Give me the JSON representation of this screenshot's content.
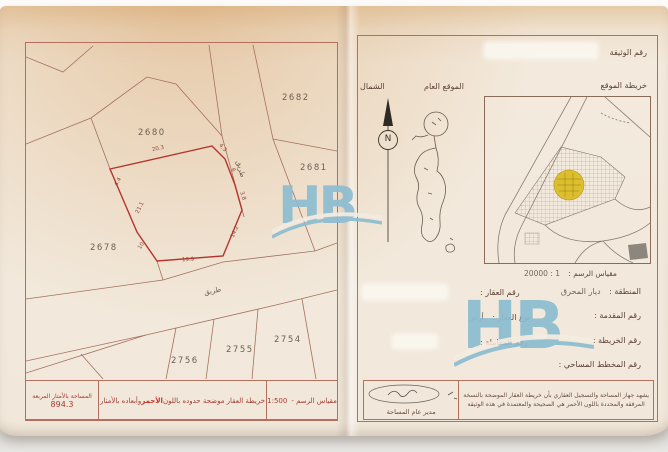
{
  "photo": {
    "brand_watermark": "HB"
  },
  "left_page": {
    "plots": {
      "p2682": "2682",
      "p2681": "2681",
      "p2680": "2680",
      "p2678": "2678",
      "p2754": "2754",
      "p2755": "2755",
      "p2756": "2756"
    },
    "roads": {
      "upper": "طريق",
      "lower": "طريق"
    },
    "dims": {
      "top": "20.3",
      "top_right": "4.3",
      "right_upper": "6",
      "right_lower": "3.8",
      "bottom_right": "14.2",
      "bottom": "19.9",
      "bottom_left": "10",
      "left": "21.1",
      "top_left": "4.4"
    },
    "footer": {
      "scale_label": "مقياس الرسم -",
      "scale_value": "1:500",
      "note_pre": "خريطة العقار موضحة حدوده باللون ",
      "note_red": "الأحمر",
      "note_post": " وأبعاده بالأمتار",
      "area_label": "المساحة بالأمتار المربعة",
      "area_value": "894.3"
    }
  },
  "right_page": {
    "doc_number_label": "رقم الوثيقة",
    "location_map_label": "خريطة الموقع",
    "general_location_label": "الموقع العام",
    "north_label": "الشمال",
    "compass_letter": "N",
    "map_scale_label": "مقياس الرسم :",
    "map_scale_value": "1 : 20000",
    "fields": {
      "region_label": "المنطقة :",
      "region_value": "ديار المحرق",
      "parcel_label": "رقم العقار :",
      "application_label": "رقم المقدمة :",
      "type_label": "نوع العقار :",
      "type_value": "أرض",
      "map_no_label": "رقم الخريطة :",
      "transaction_label": "رقم المعاملة :",
      "survey_plan_label": "رقم المخطط المساحي :"
    },
    "certification_line1": "يشهد جهاز المساحة والتسجيل العقاري بأن خريطة العقار الموضحة بالنسخة",
    "certification_line2": "المرفقة والمحددة باللون الأحمر هي الصحيحة والمعتمدة في هذه الوثيقة",
    "signature_title": "مدير عام المساحة"
  }
}
